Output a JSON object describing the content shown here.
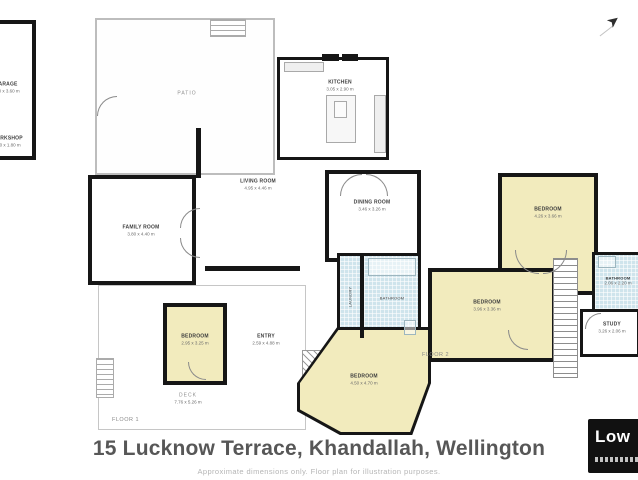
{
  "meta": {
    "title": "15 Lucknow Terrace, Khandallah, Wellington",
    "disclaimer": "Approximate dimensions only. Floor plan for illustration purposes.",
    "logo_text": "Low",
    "compass_glyph": "➤"
  },
  "colors": {
    "wall": "#161616",
    "bedroom_yellow": "#f2ebbd",
    "bathroom_blue": "#cfe4ec",
    "patio_outline": "#bdbdbd",
    "title_gray": "#575757",
    "logo_bg": "#111111"
  },
  "floor1": {
    "label": "FLOOR 1",
    "garage": {
      "name": "GARAGE",
      "dims": "5.90 x 3.60 m"
    },
    "workshop": {
      "name": "WORKSHOP",
      "dims": "2.70 x 1.80 m"
    },
    "patio": {
      "name": "PATIO"
    },
    "kitchen": {
      "name": "KITCHEN",
      "dims": "3.05 x 2.90 m"
    },
    "living": {
      "name": "LIVING ROOM",
      "dims": "4.95 x 4.46 m"
    },
    "dining": {
      "name": "DINING ROOM",
      "dims": "3.46 x 3.26 m"
    },
    "family": {
      "name": "FAMILY ROOM",
      "dims": "3.80 x 4.40 m"
    },
    "bedroom1": {
      "name": "BEDROOM",
      "dims": "2.95 x 3.25 m"
    },
    "entry": {
      "name": "ENTRY",
      "dims": "2.59 x 4.88 m"
    },
    "bedroom2": {
      "name": "BEDROOM",
      "dims": "4.50 x 4.70 m"
    },
    "deck": {
      "name": "DECK",
      "dims": "7.76 x 5.26 m"
    },
    "bathroom": {
      "name": "BATHROOM"
    },
    "laundry": {
      "name": "LAUNDRY"
    }
  },
  "floor2": {
    "label": "FLOOR 2",
    "bedroom3": {
      "name": "BEDROOM",
      "dims": "4.26 x 3.66 m"
    },
    "bedroom4": {
      "name": "BEDROOM",
      "dims": "3.96 x 3.36 m"
    },
    "bathroom": {
      "name": "BATHROOM",
      "dims": "2.06 x 2.20 m"
    },
    "study": {
      "name": "STUDY",
      "dims": "3.26 x 2.06 m"
    }
  }
}
